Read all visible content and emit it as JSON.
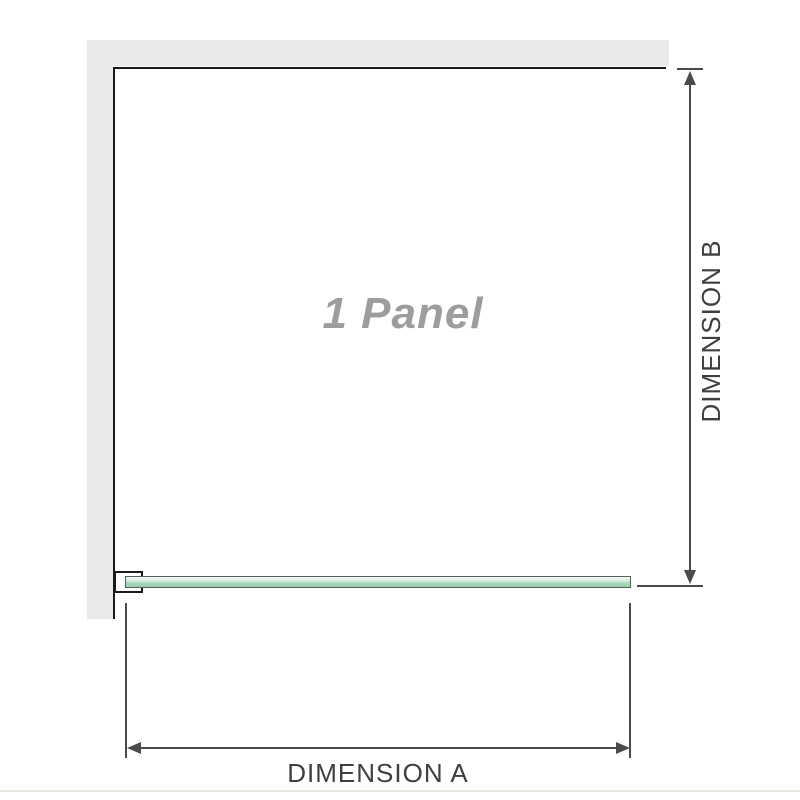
{
  "diagram": {
    "panel_label": "1 Panel",
    "dimension_a_label": "DIMENSION A",
    "dimension_b_label": "DIMENSION B"
  },
  "colors": {
    "background": "#ffffff",
    "wall-fill": "#e9e9e9",
    "outline-dark": "#1a1a1a",
    "dimension-line": "#4a4a4a",
    "label-text": "#3f3f3f",
    "panel-label-text": "#9d9d9d",
    "glass-border": "#52615a",
    "glass-fill": "#a5d7b8",
    "glass-highlight": "#dff0e7",
    "baseline-divider": "#e9e6df"
  }
}
